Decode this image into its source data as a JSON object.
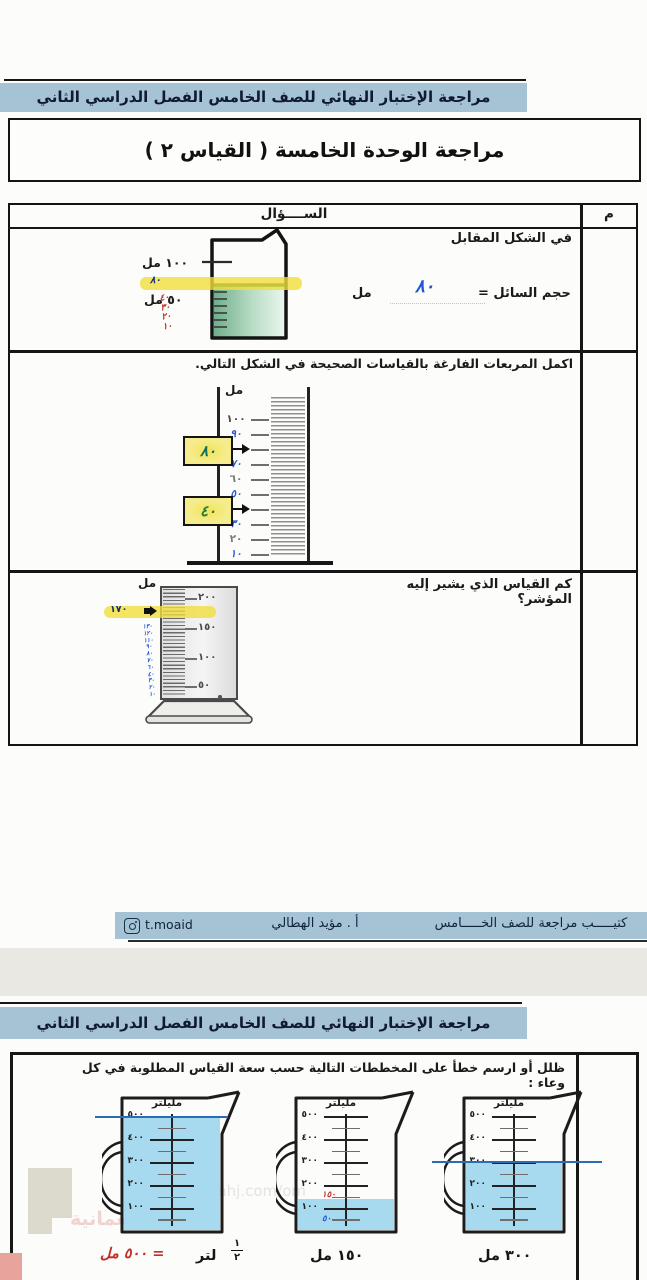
{
  "colors": {
    "header_bar": "#a6c3d5",
    "highlight": "#f0de3c",
    "handwriting_blue": "#2356d6",
    "handwriting_red": "#c03028",
    "liquid_green": "#83bb98",
    "water_blue": "#a7d9ef"
  },
  "page1": {
    "header": "مراجعة الإختبار النهائي للصف الخامس الفصل الدراسي الثاني",
    "title": "مراجعة الوحدة الخامسة ( القياس ٢ )",
    "table": {
      "question_col": "الســــؤال",
      "num_col": "م"
    },
    "q1": {
      "prompt": "في الشكل المقابل",
      "answer_label": "حجم السائل =",
      "answer_value": "٨٠",
      "unit": "مل",
      "beaker": {
        "top_label": "١٠٠ مل",
        "mid_label": "٥٠ مل",
        "hw_level": "٨٠",
        "hw_red": [
          "٤٠",
          "٣٠",
          "٢٠",
          "١٠"
        ]
      }
    },
    "q2": {
      "prompt": "اكمل المربعات الفارغة بالقياسات الصحيحة في الشكل التالي.",
      "unit": "مل",
      "scale": [
        "١٠٠",
        "٩٠",
        "٨٠",
        "٧٠",
        "٦٠",
        "٥٠",
        "٤٠",
        "٣٠",
        "٢٠",
        "١٠"
      ]
    },
    "q3": {
      "prompt": "كم القياس الذي يشير إليه المؤشر؟",
      "unit": "مل",
      "scale": [
        "٢٠٠",
        "١٥٠",
        "١٠٠",
        "٥٠"
      ],
      "pointer_value": "١٧٠",
      "side_hw": [
        "١٣٠",
        "١٢٠",
        "١١٠",
        "٩٠",
        "٨٠",
        "٧٠",
        "٦٠",
        "٤٠",
        "٣٠",
        "٢٠",
        "١٠"
      ]
    },
    "footer": {
      "booklet": "كتيـــــب مراجعة للصف الخـــــامس",
      "teacher": "أ . مؤيد الهطالي",
      "instagram": "t.moaid"
    }
  },
  "page2": {
    "header": "مراجعة الإختبار النهائي للصف الخامس الفصل الدراسي الثاني",
    "q4": {
      "prompt": "ظلل أو ارسم خطأ على المخططات التالية حسب سعة القياس المطلوبة في كل وعاء :",
      "unit_label": "مليلتر",
      "scale": [
        "٥٠٠",
        "٤٠٠",
        "٣٠٠",
        "٢٠٠",
        "١٠٠"
      ],
      "jug_right_label": "٣٠٠ مل",
      "jug_mid_label": "١٥٠ مل",
      "jug_mid_hw_red": "١٥٠",
      "jug_mid_hw_blue": "٥٠",
      "jug_left_frac_num": "١",
      "jug_left_frac_den": "٢",
      "jug_left_unit": "لتر",
      "jug_left_hw_red": "= ٥٠٠ مل"
    },
    "watermark": {
      "arabic": "المناهج العمانية",
      "latin": "almnahj.com/om"
    }
  }
}
